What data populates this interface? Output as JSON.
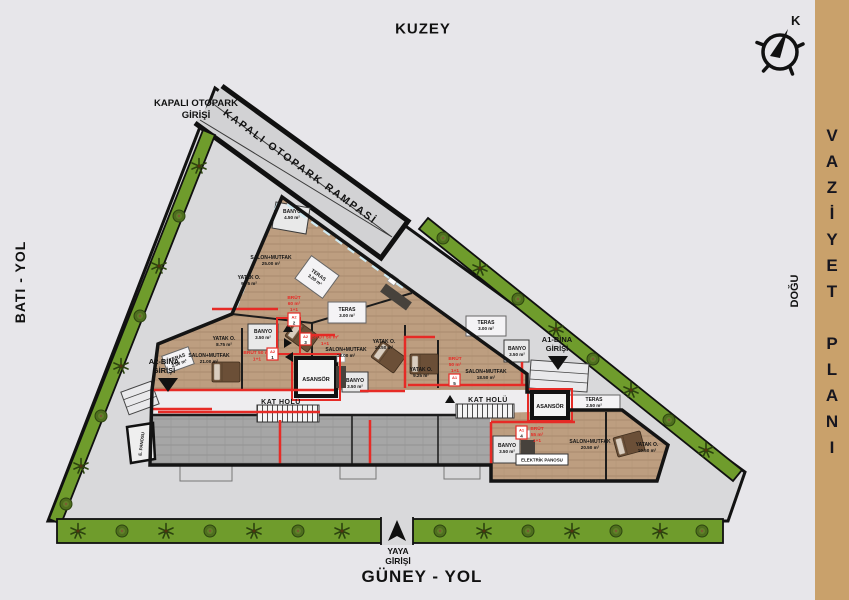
{
  "headings": {
    "north": "KUZEY",
    "west": "BATI - YOL",
    "east": "DOĞU",
    "south": "GÜNEY - YOL",
    "compass": "K"
  },
  "side_panel": {
    "word1": "VAZİYET",
    "word2": "PLANI"
  },
  "entrances": {
    "parking_line1": "KAPALI OTOPARK",
    "parking_line2": "GİRİŞİ",
    "ramp": "KAPALI OTOPARK RAMPASİ",
    "pedestrian_line1": "YAYA",
    "pedestrian_line2": "GİRİŞİ",
    "a2_line1": "A2-BİNA",
    "a2_line2": "GİRİŞİ",
    "a1_line1": "A1-BİNA",
    "a1_line2": "GİRİŞİ"
  },
  "halls": {
    "kat_holu": "KAT HOLÜ",
    "asansor": "ASANSÖR",
    "panel": "ELEKTRİK PANOSU",
    "panel_short": "E. PANOSU"
  },
  "rooms": [
    {
      "name": "BANYO",
      "area": "4.50 m²"
    },
    {
      "name": "SALON+MUTFAK",
      "area": "25.00 m²"
    },
    {
      "name": "YATAK O.",
      "area": "9.75 m²"
    },
    {
      "name": "TERAS",
      "area": "3.00 m²"
    },
    {
      "name": "YATAK O.",
      "area": "8.75 m²"
    },
    {
      "name": "BANYO",
      "area": "3.50 m²"
    },
    {
      "name": "SALON+MUTFAK",
      "area": "21.00 m²"
    },
    {
      "name": "TERAS",
      "area": "2.50 m²"
    },
    {
      "name": "TERAS",
      "area": "3.00 m²"
    },
    {
      "name": "SALON+MUTFAK",
      "area": "18.00 m²"
    },
    {
      "name": "BANYO",
      "area": "3.50 m²"
    },
    {
      "name": "YATAK O.",
      "area": "10.50 m²"
    },
    {
      "name": "YATAK O.",
      "area": "9.25 m²"
    },
    {
      "name": "TERAS",
      "area": "3.00 m²"
    },
    {
      "name": "SALON+MUTFAK",
      "area": "18.50 m²"
    },
    {
      "name": "BANYO",
      "area": "3.50 m²"
    },
    {
      "name": "TERAS",
      "area": "2.50 m²"
    },
    {
      "name": "BANYO",
      "area": "3.50 m²"
    },
    {
      "name": "SALON+MUTFAK",
      "area": "20.50 m²"
    },
    {
      "name": "YATAK O.",
      "area": "10.50 m²"
    }
  ],
  "units": [
    {
      "code": "A2",
      "no": "2",
      "lines": [
        "BRÜT",
        "60 m²",
        "1+1"
      ]
    },
    {
      "code": "A2",
      "no": "1",
      "lines": [
        "BRÜT 50 m²",
        "1+1"
      ]
    },
    {
      "code": "A2",
      "no": "3",
      "lines": [
        "BRÜT 50 m²",
        "1+1"
      ]
    },
    {
      "code": "A1",
      "no": "5",
      "lines": [
        "BRÜT",
        "50 m²",
        "1+1"
      ]
    },
    {
      "code": "A1",
      "no": "4",
      "lines": [
        "BRÜT",
        "55 m²",
        "1+1"
      ]
    }
  ],
  "colors": {
    "accent_red": "#e62b26",
    "greenbelt": "#6f9c2c",
    "panel_tan": "#c9a16b",
    "pavement": "#d9d9db"
  }
}
